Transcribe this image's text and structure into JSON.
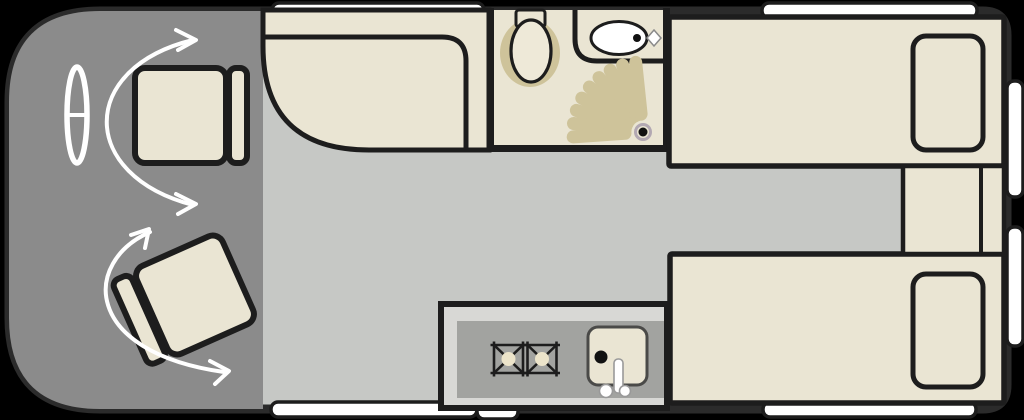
{
  "page": {
    "background": "#000000",
    "type": "floor-plan",
    "subject": "motorhome-campervan-top-view-layout"
  },
  "colors": {
    "floor": "#c6c8c5",
    "cab_floor": "#8b8b8b",
    "body_outline": "#2b2b2b",
    "furniture": "#eae5d3",
    "furniture_light": "#eee9d8",
    "outline": "#1d1d1d",
    "accent_khaki": "#cec39a",
    "burner_center": "#ece4ca",
    "counter": "#d8d8d5",
    "worktop": "#a2a3a0",
    "window": "#ffffff",
    "arrow": "#ffffff",
    "drain": "#111111",
    "drain_halo": "#b2a8b2",
    "sink_outline": "#4a4a48",
    "faucet_outline": "#999999",
    "tap_outline": "#8a8a8a"
  },
  "areas": {
    "cab": {
      "items": [
        "steering-wheel-icon",
        "driver-seat",
        "swivel-seat",
        "rotation-arrow",
        "rotation-arrow"
      ]
    },
    "lounge": {
      "items": [
        "curved-bench-seat"
      ]
    },
    "bathroom": {
      "items": [
        "toilet-icon",
        "washbasin-icon",
        "tap-icon",
        "shower-spray-icon",
        "shower-drain"
      ]
    },
    "kitchen": {
      "items": [
        "gas-burner-icon",
        "gas-burner-icon",
        "kitchen-sink",
        "faucet-icon"
      ]
    },
    "bedroom": {
      "items": [
        "single-bed",
        "single-bed",
        "pillow",
        "pillow",
        "bedside-cabinet"
      ]
    },
    "exterior": {
      "window_count": 6,
      "entry_step_count": 1
    }
  }
}
